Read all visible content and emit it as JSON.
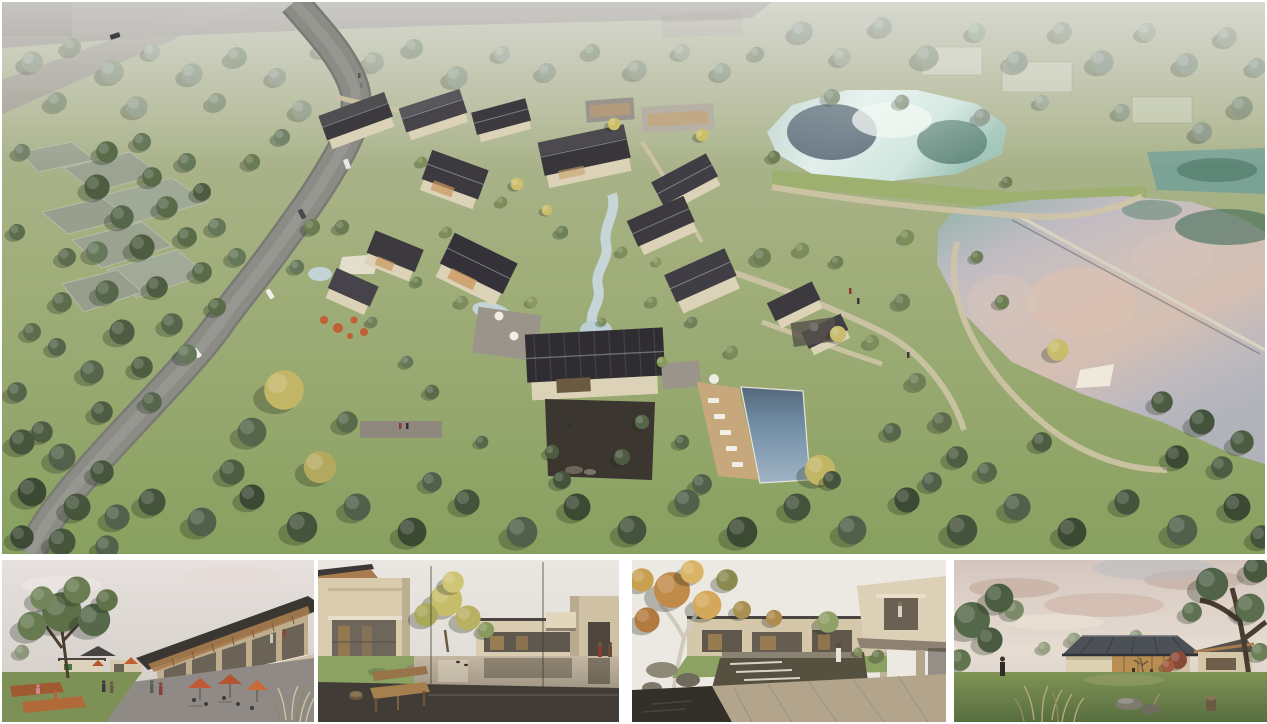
{
  "page": {
    "title": "Resort village masterplan — rendering collage"
  },
  "panels": {
    "aerial": {
      "id": "aerial",
      "label": "Aerial rendering of a village resort: winding road on the left, cluster of dark pitched-roof buildings in the center with a stream and swimming pool, an upper pond and a large lake on the right, surrounded by woodland and fields"
    },
    "thumbnails": [
      {
        "id": "street-plaza",
        "label": "Street-level rendering of the village plaza with cafe umbrellas, people and a two-storey timber-roofed building"
      },
      {
        "id": "courtyard-pond",
        "label": "Rendering of a courtyard with a reflecting pond, wooden bench and beige houses"
      },
      {
        "id": "waterfall-courtyard",
        "label": "Rendering of a water courtyard with a cascading weir, autumn tree and cantilevered balconies"
      },
      {
        "id": "garden-pavilion",
        "label": "Dusk rendering of a single-storey glass pavilion with a dark hipped roof in a garden"
      }
    ]
  },
  "colors": {
    "canvas": "#ffffff",
    "grass": "#9fb078",
    "grass-dark": "#86a05e",
    "forest": "#4e5d41",
    "forest-faded": "#8a9781",
    "road": "#8c8c86",
    "path": "#cfc5a7",
    "roof": "#3c3a3e",
    "wall": "#dcd2b8",
    "timber": "#a87c4e",
    "pond": "#cfe5de",
    "lake": "#c9bfc2",
    "lake-pink": "#d9c2b2",
    "pool": "#7290a8",
    "autumn": "#c9b461",
    "umbrella": "#c05a38",
    "corten": "#a05a32",
    "pavement": "#8f8a85",
    "water-dark": "#46413b",
    "sky-dusk": "#d7c9c0"
  }
}
